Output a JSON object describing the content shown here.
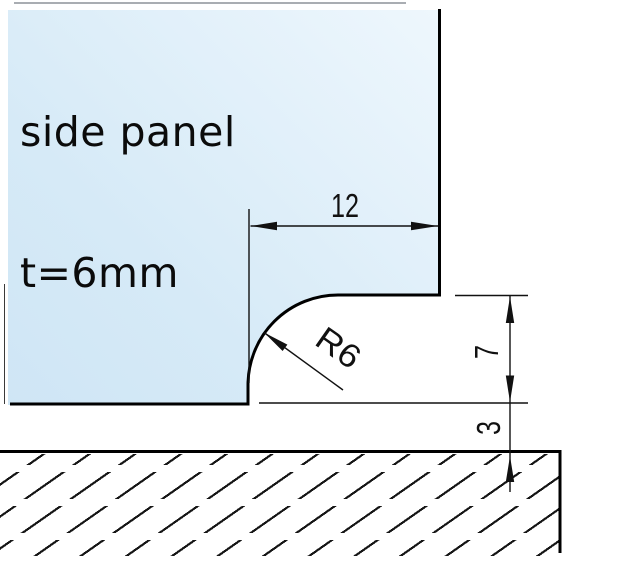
{
  "title": {
    "line1": "side panel",
    "line2": "t=6mm"
  },
  "dimensions": {
    "notch_width_mm": "12",
    "step_height_mm": "7",
    "gap_mm": "3",
    "fillet_radius": "R6"
  },
  "colors": {
    "panel_gradient_light": "#f7fcfe",
    "panel_gradient_dark": "#cbe3f4",
    "object_line": "#000000",
    "dimension_line": "#111111",
    "hatch_line": "#161616"
  }
}
